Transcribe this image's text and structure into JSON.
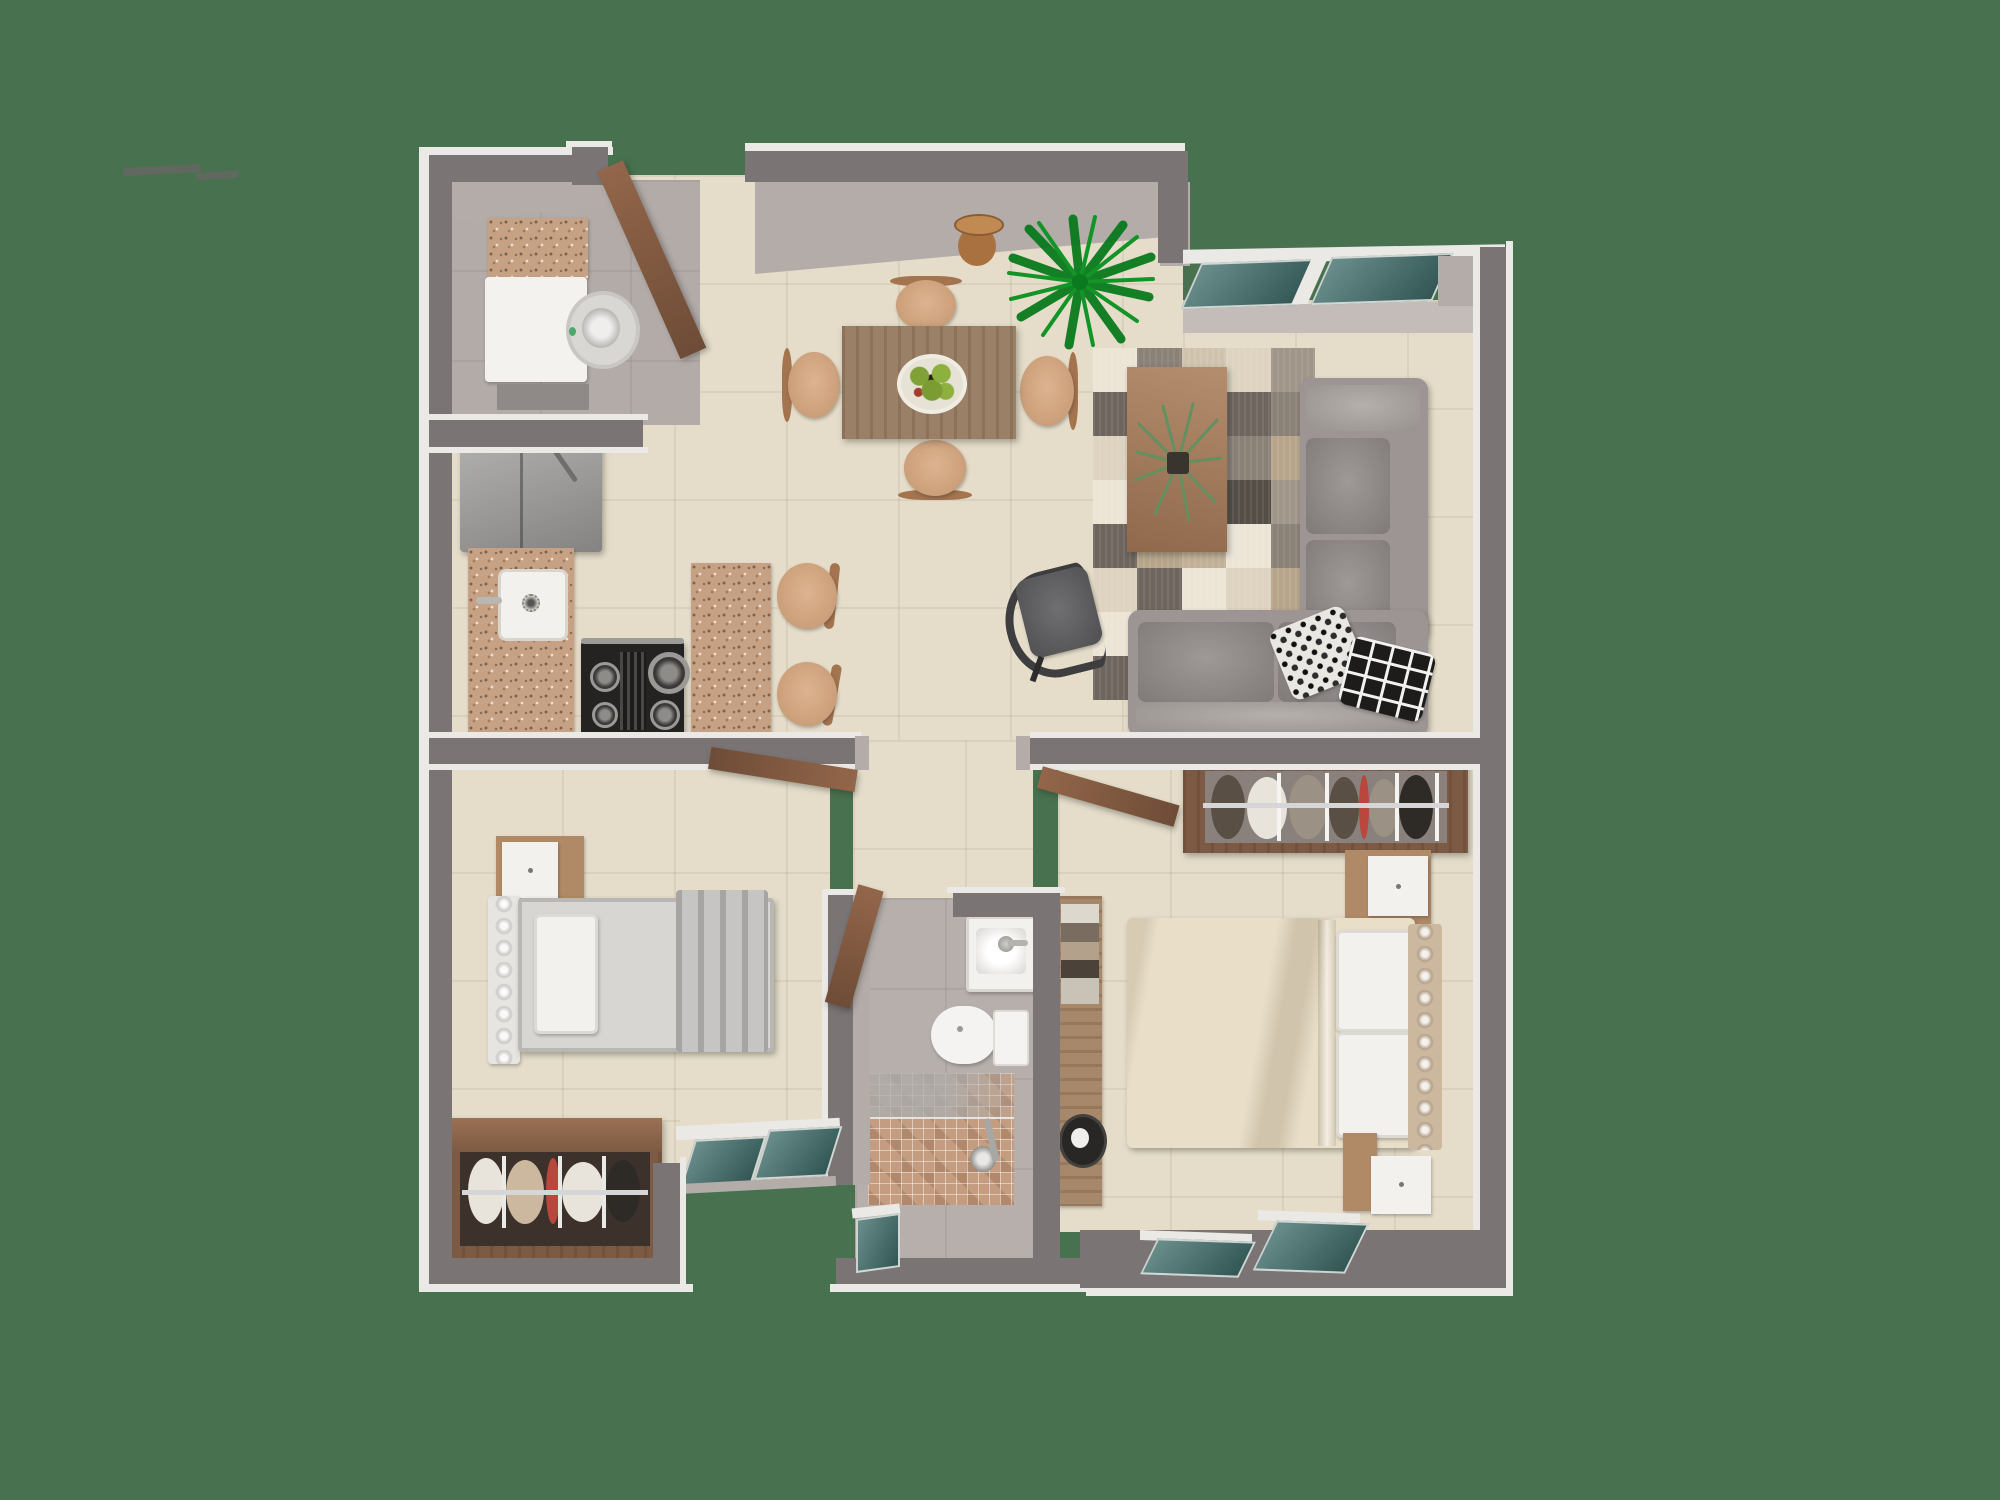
{
  "title": "3D apartment floor plan - top-down architectural render",
  "background": "#48714f",
  "palette": {
    "wallDark": "#7a7475",
    "wallTrim": "#ebe9e6",
    "wallLight": "#b4aca8",
    "sillBand": "#c3bcb8",
    "glass": "#3f6e6a",
    "floor": "#e5ddca",
    "floorGray": "#b2aba8",
    "bathFloor": "#b6afac",
    "granite": "#c6a183",
    "wood": "#81583f",
    "woodLight": "#a77e5e",
    "tableWood": "#9b8068",
    "fridge": "#9b9a99",
    "stove": "#242322",
    "washer": "#f3f2ef",
    "drum": "#d9d7d4",
    "drumDot": "#4ca96b",
    "sink": "#f2f1ee",
    "sofa": "#9c9593",
    "sofaLight": "#a9a29f",
    "sofaSeat": "#8e8785",
    "chairTan": "#d8a77d",
    "chairBack": "#a4744f",
    "officeChair": "#58585a",
    "bedCream": "#e9dfc9",
    "pillowWhite": "#f3f1ed",
    "headboardChampagne": "#ccb89e",
    "bedGray": "#d8d6d3",
    "headboardWhite": "#e7e5e2",
    "blanketGray": "#c7c5c3",
    "closetWood": "#7c5a43",
    "closetBack": "#8b817c",
    "wardrobeBack": "#3c322b",
    "railSilver": "#d6d6d8",
    "shelfWood": "#a8886a",
    "hatBlack": "#282726",
    "mosaic": "#c49d81",
    "toilet": "#f4f3f1",
    "palm": "#129427",
    "palmDark": "#0a7a1e",
    "plantGray": "#64905f",
    "potDark": "#3a342e",
    "nightWood": "#b08a66",
    "nightWhite": "#f2f1ee",
    "bowlWhite": "#e6e2d5",
    "vaseBrown": "#a9713f",
    "clothWhite": "#e8e4dc",
    "clothBeige": "#cbb89e",
    "clothBrown": "#5a4f45",
    "clothDark": "#2e2a26",
    "clothGray": "#9b9184",
    "clothRed": "#b9473e",
    "artifact": "#6a6665"
  },
  "rug": {
    "patch_colors": [
      "#ece5d6",
      "#cfc3ae",
      "#a0968a",
      "#6e665e",
      "#c2b198",
      "#8a8177",
      "#ddd3c0",
      "#544e47",
      "#b7a58b"
    ]
  },
  "rooms": {
    "entry": "Entry",
    "laundry": "Laundry",
    "kitchen": "Kitchen",
    "dining": "Dining area",
    "living": "Living room",
    "hall": "Hallway",
    "bathroom": "Bathroom",
    "bedroom_left": "Bedroom 2",
    "bedroom_master": "Master bedroom",
    "closet": "Closet",
    "wardrobe": "Wardrobe"
  }
}
